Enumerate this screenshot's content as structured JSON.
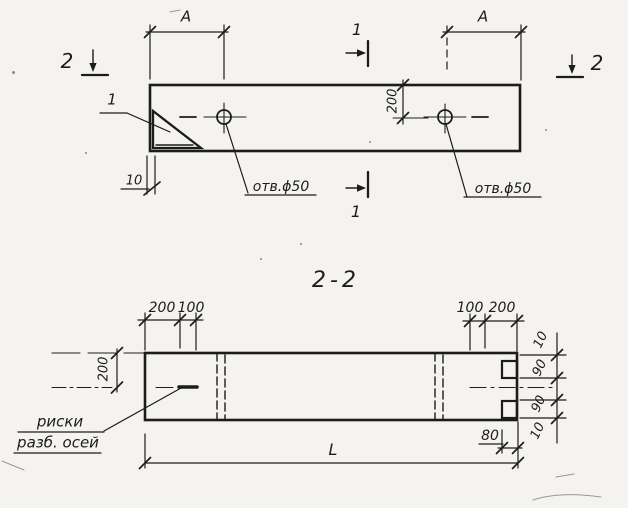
{
  "palette": {
    "paper": "#f4f3ef",
    "ink": "#1c1c1c"
  },
  "plan_view": {
    "span_label_left": "A",
    "span_label_right": "A",
    "offset_dim_200": "200",
    "edge_offset_dim_10": "10",
    "hole_label_left": "отв.ϕ50",
    "hole_label_right": "отв.ϕ50",
    "corner_detail_callout": "1",
    "section_cut_1_top": "1",
    "section_cut_1_bottom": "1",
    "section_cut_2_left": "2",
    "section_cut_2_right": "2"
  },
  "section_view": {
    "title": "2-2",
    "top_left_dims": [
      "200",
      "100"
    ],
    "top_right_dims": [
      "100",
      "200"
    ],
    "left_height_dim": "200",
    "right_edge_dims": [
      "10",
      "90",
      "90",
      "10"
    ],
    "notch_offset_dim": "80",
    "overall_length_dim": "L",
    "axis_marks_label_line1": "риски",
    "axis_marks_label_line2": "разб. осей"
  }
}
